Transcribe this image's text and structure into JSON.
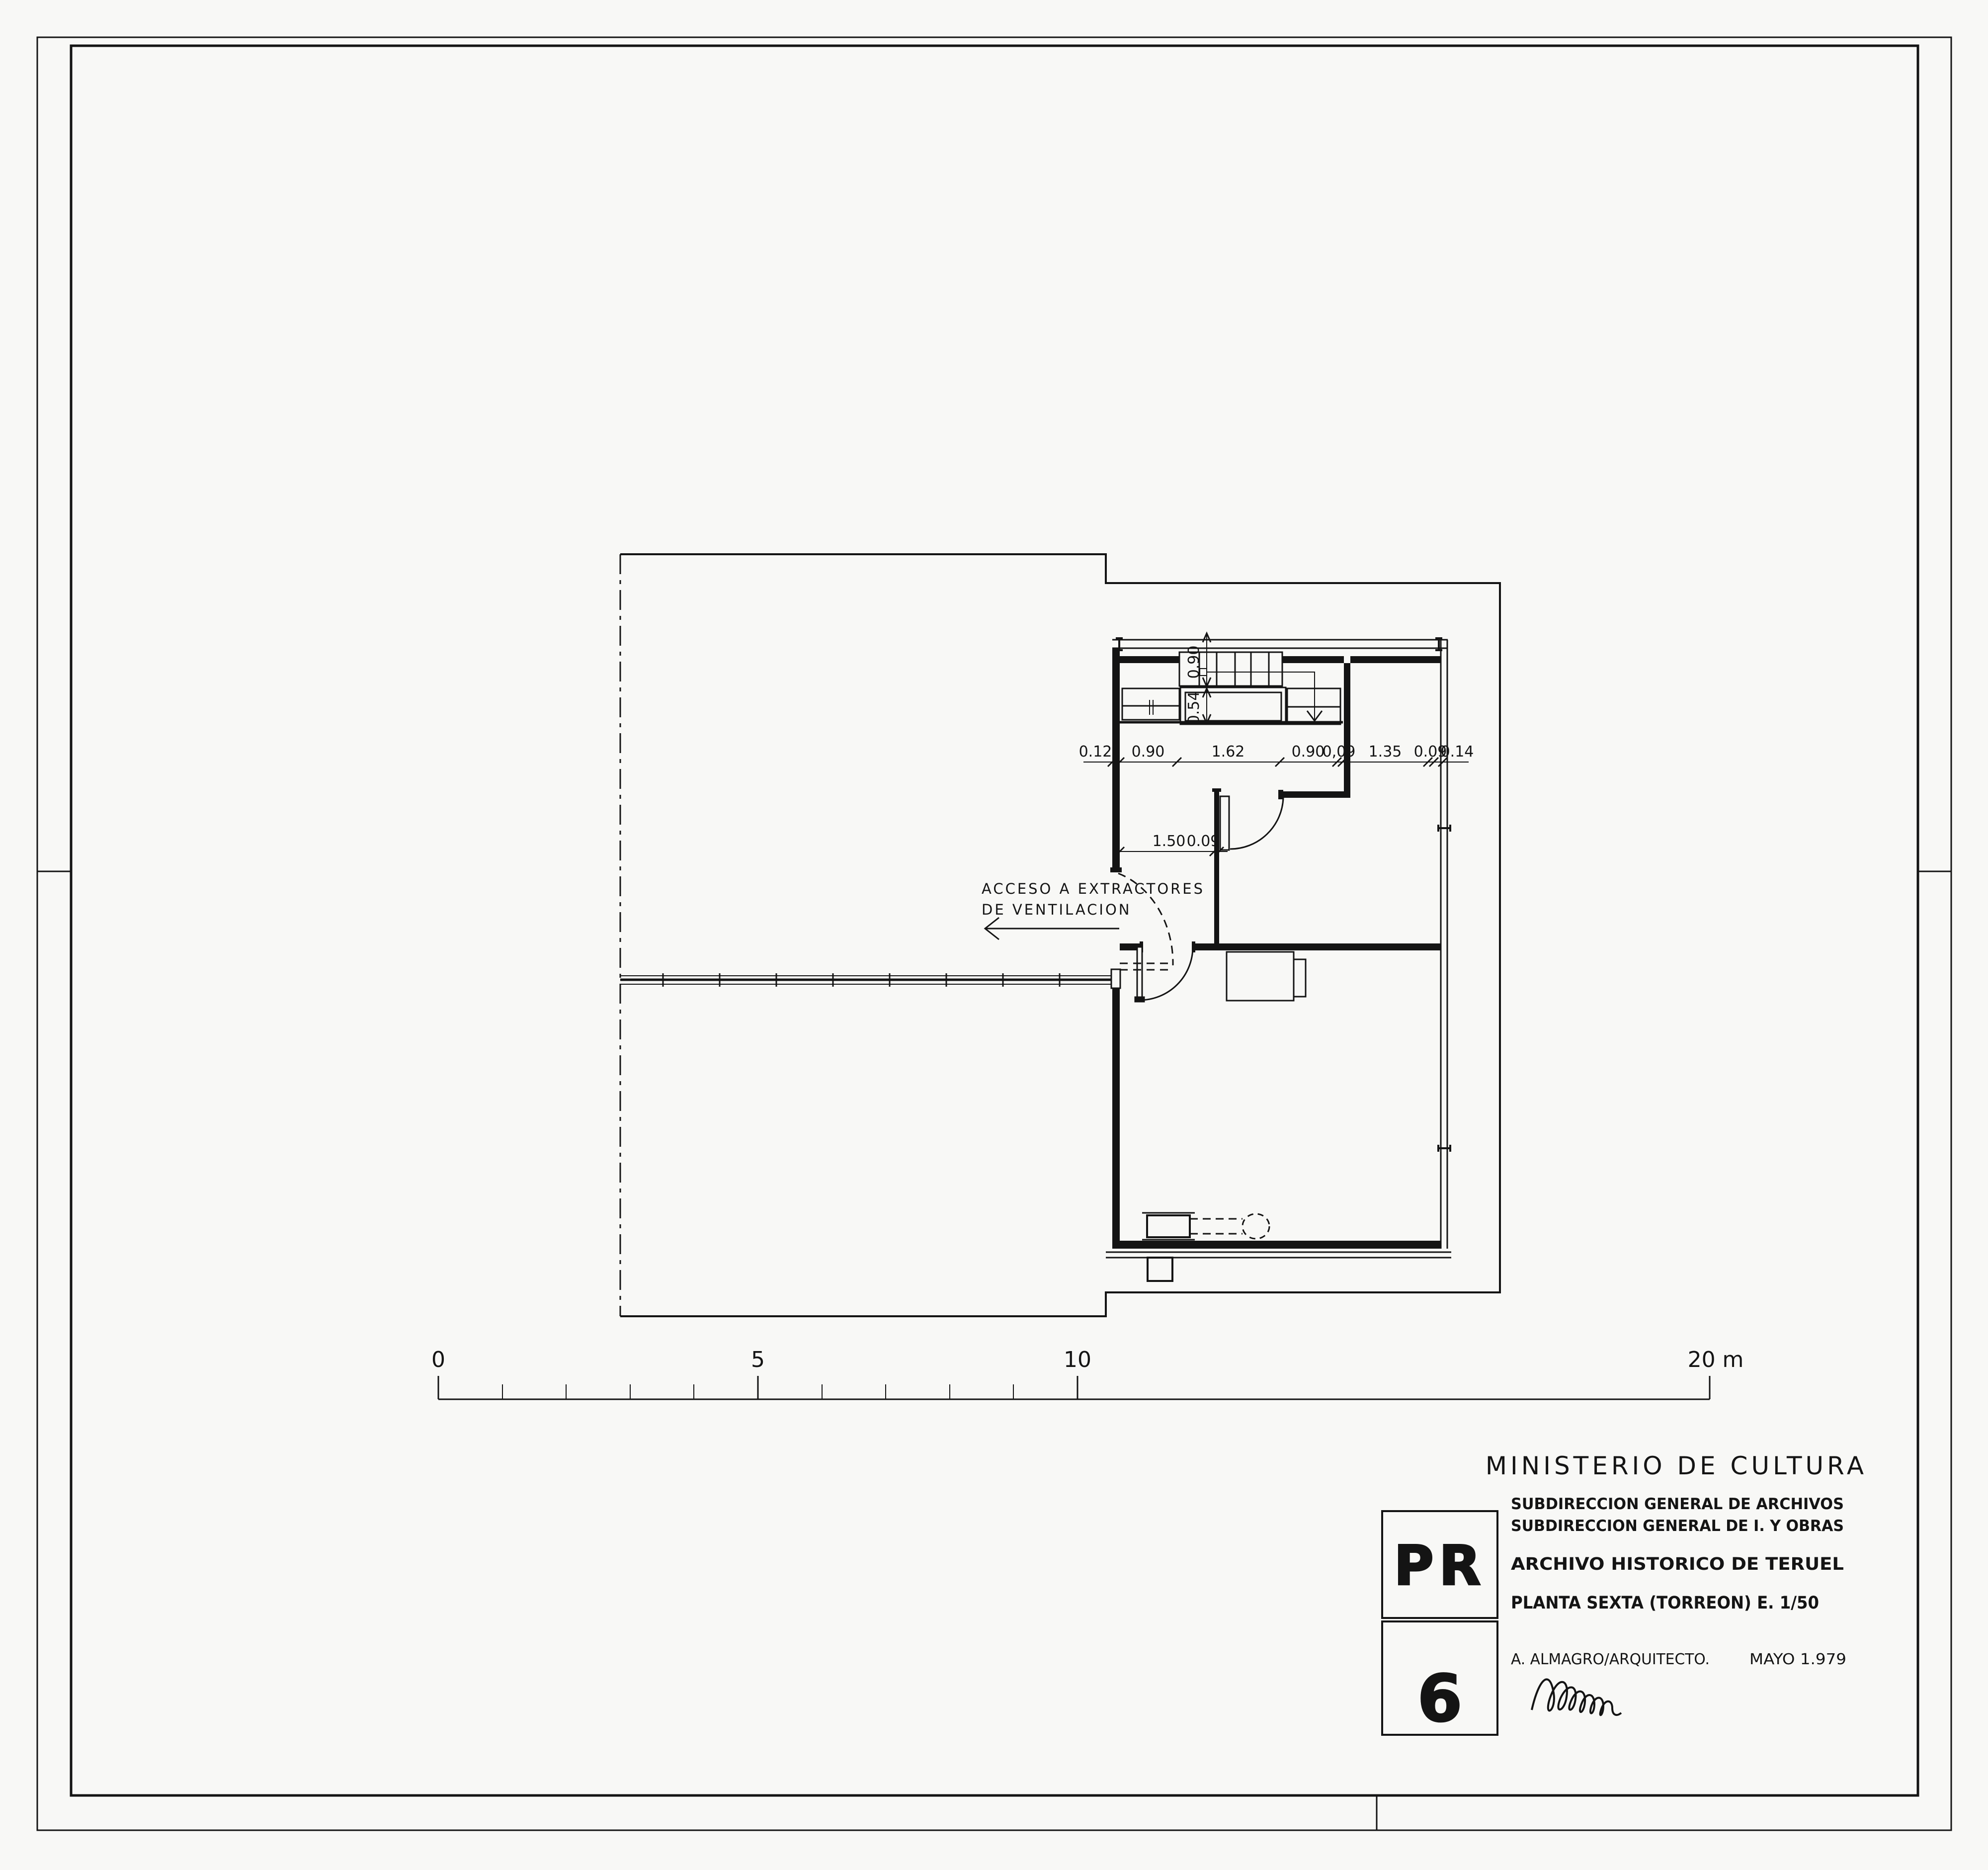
{
  "drawing": {
    "annotations": {
      "acceso_line1": "ACCESO A EXTRACTORES",
      "acceso_line2": "DE VENTILACION"
    },
    "dimensions": {
      "chain": [
        "0.12",
        "0.90",
        "1.62",
        "0.90",
        "0,09",
        "1.35",
        "0.09",
        "0.14"
      ],
      "hall_width": "1.50",
      "hall_wall": "0.09",
      "stair_flight": "0.90",
      "stair_landing": "0.54"
    },
    "scale_bar": {
      "tick_0": "0",
      "tick_5": "5",
      "tick_10": "10",
      "tick_20": "20 m"
    }
  },
  "title_block": {
    "ministry": "MINISTERIO DE CULTURA",
    "department_line1": "SUBDIRECCION GENERAL DE ARCHIVOS",
    "department_line2": "SUBDIRECCION GENERAL DE I. Y OBRAS",
    "project": "ARCHIVO HISTORICO DE TERUEL",
    "sheet": "PLANTA SEXTA (TORREON) E. 1/50",
    "architect": "A. ALMAGRO/ARQUITECTO.",
    "date": "MAYO 1.979",
    "stamp_top": "PR",
    "stamp_bottom": "6"
  },
  "colors": {
    "paper": "#f8f8f6",
    "ink": "#141414"
  }
}
